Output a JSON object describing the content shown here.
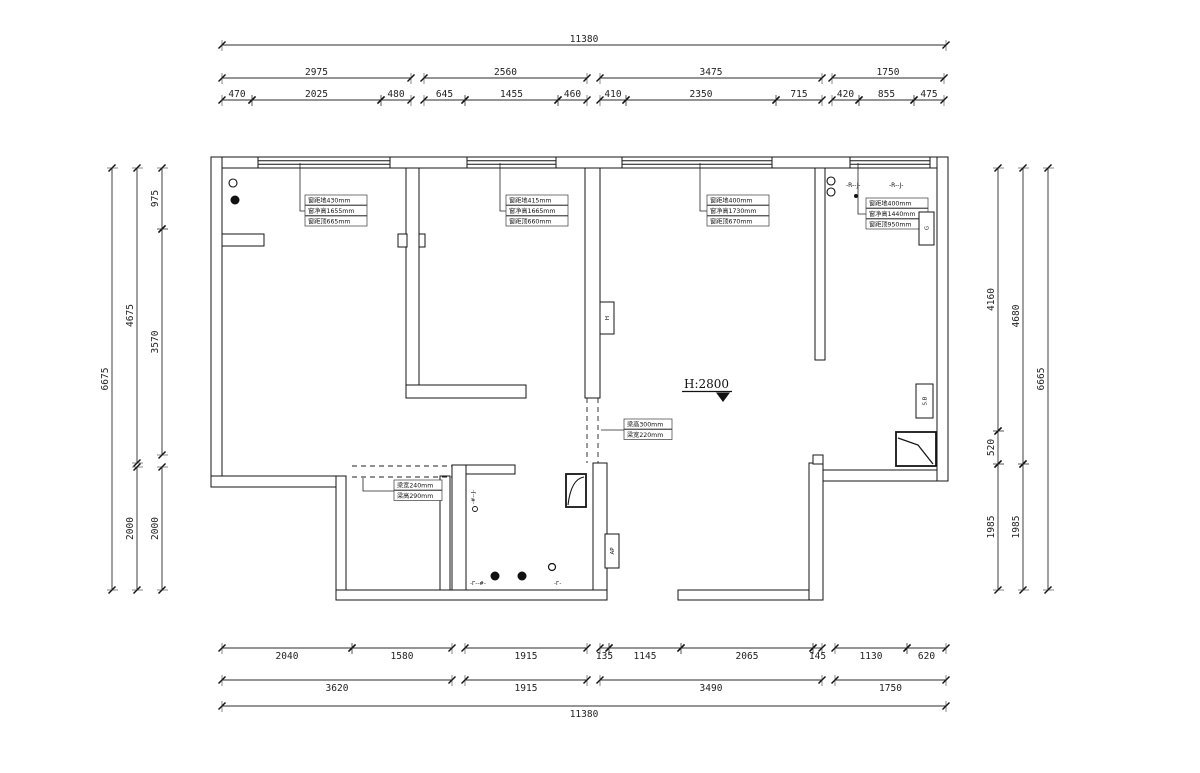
{
  "drawing": {
    "type": "floor-plan",
    "elevation_label": "H:2800",
    "line_color": "#141414",
    "dim_color": "#2b2b2b"
  },
  "annotations": {
    "win1": {
      "lines": [
        "窗距地430mm",
        "窗净高1655mm",
        "窗距顶665mm"
      ]
    },
    "win2": {
      "lines": [
        "窗距地415mm",
        "窗净高1665mm",
        "窗距顶660mm"
      ]
    },
    "win3": {
      "lines": [
        "窗距地400mm",
        "窗净高1730mm",
        "窗距顶670mm"
      ]
    },
    "win4": {
      "lines": [
        "窗距地400mm",
        "窗净高1440mm",
        "窗距顶950mm"
      ]
    },
    "beam_center": {
      "lines": [
        "梁高300mm",
        "梁宽220mm"
      ]
    },
    "beam_left": {
      "lines": [
        "梁宽240mm",
        "梁高290mm"
      ]
    }
  },
  "labels": {
    "elevation": "H:2800",
    "box_h": "H",
    "box_ap": "AP",
    "box_sb": "S.B",
    "box_g": "G",
    "rj1": "-R--J-",
    "rj2": "-R--J-",
    "rj_vertical": "-#--J-",
    "entry_a": "-Г--#-",
    "entry_b": "-Г-"
  },
  "dim_rows": [
    {
      "orient": "h",
      "side": "top",
      "y": 45,
      "segs": [
        [
          222,
          946,
          "11380"
        ]
      ]
    },
    {
      "orient": "h",
      "side": "top",
      "y": 78,
      "segs": [
        [
          222,
          411,
          "2975"
        ],
        [
          424,
          587,
          "2560"
        ],
        [
          600,
          822,
          "3475"
        ],
        [
          832,
          944,
          "1750"
        ]
      ]
    },
    {
      "orient": "h",
      "side": "top",
      "y": 100,
      "segs": [
        [
          222,
          252,
          "470"
        ],
        [
          252,
          381,
          "2025"
        ],
        [
          381,
          411,
          "480"
        ],
        [
          424,
          465,
          "645"
        ],
        [
          465,
          558,
          "1455"
        ],
        [
          558,
          587,
          "460"
        ],
        [
          600,
          626,
          "410"
        ],
        [
          626,
          776,
          "2350"
        ],
        [
          776,
          822,
          "715"
        ],
        [
          832,
          859,
          "420"
        ],
        [
          859,
          914,
          "855"
        ],
        [
          914,
          944,
          "475"
        ]
      ]
    },
    {
      "orient": "h",
      "side": "bottom",
      "y": 648,
      "segs": [
        [
          222,
          352,
          "2040"
        ],
        [
          352,
          452,
          "1580"
        ],
        [
          465,
          587,
          "1915"
        ],
        [
          600,
          609,
          "135"
        ],
        [
          609,
          681,
          "1145"
        ],
        [
          681,
          813,
          "2065"
        ],
        [
          813,
          822,
          "145"
        ],
        [
          835,
          907,
          "1130"
        ],
        [
          907,
          946,
          "620"
        ]
      ]
    },
    {
      "orient": "h",
      "side": "bottom",
      "y": 680,
      "segs": [
        [
          222,
          452,
          "3620"
        ],
        [
          465,
          587,
          "1915"
        ],
        [
          600,
          822,
          "3490"
        ],
        [
          835,
          946,
          "1750"
        ]
      ]
    },
    {
      "orient": "h",
      "side": "bottom",
      "y": 706,
      "segs": [
        [
          222,
          946,
          "11380"
        ]
      ]
    },
    {
      "orient": "v",
      "side": "left",
      "x": 112,
      "segs": [
        [
          168,
          590,
          "6675"
        ]
      ]
    },
    {
      "orient": "v",
      "side": "left",
      "x": 137,
      "segs": [
        [
          168,
          463,
          "4675"
        ],
        [
          467,
          590,
          "2000"
        ]
      ]
    },
    {
      "orient": "v",
      "side": "left",
      "x": 162,
      "segs": [
        [
          168,
          229,
          "975"
        ],
        [
          229,
          455,
          "3570"
        ],
        [
          467,
          590,
          "2000"
        ]
      ]
    },
    {
      "orient": "v",
      "side": "right",
      "x": 998,
      "segs": [
        [
          168,
          431,
          "4160"
        ],
        [
          431,
          464,
          "520"
        ],
        [
          464,
          590,
          "1985"
        ]
      ]
    },
    {
      "orient": "v",
      "side": "right",
      "x": 1023,
      "segs": [
        [
          168,
          464,
          "4680"
        ],
        [
          464,
          590,
          "1985"
        ]
      ]
    },
    {
      "orient": "v",
      "side": "right",
      "x": 1048,
      "segs": [
        [
          168,
          590,
          "6665"
        ]
      ]
    }
  ]
}
